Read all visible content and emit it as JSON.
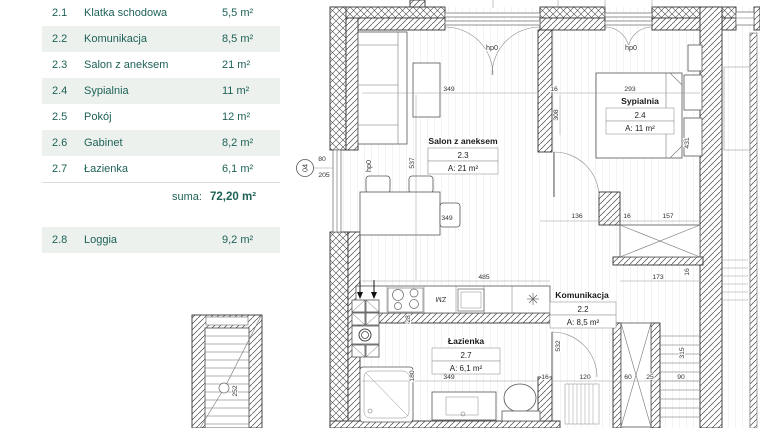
{
  "accent_color": "#1e6257",
  "row_alt_color": "#edf1ed",
  "table": {
    "rows": [
      {
        "no": "2.1",
        "name": "Klatka schodowa",
        "area": "5,5 m²"
      },
      {
        "no": "2.2",
        "name": "Komunikacja",
        "area": "8,5 m²"
      },
      {
        "no": "2.3",
        "name": "Salon z aneksem",
        "area": "21 m²"
      },
      {
        "no": "2.4",
        "name": "Sypialnia",
        "area": "11 m²"
      },
      {
        "no": "2.5",
        "name": "Pokój",
        "area": "12 m²"
      },
      {
        "no": "2.6",
        "name": "Gabinet",
        "area": "8,2 m²"
      },
      {
        "no": "2.7",
        "name": "Łazienka",
        "area": "6,1 m²"
      }
    ],
    "suma_label": "suma:",
    "suma_value": "72,20 m²",
    "extra_row": {
      "no": "2.8",
      "name": "Loggia",
      "area": "9,2 m²"
    }
  },
  "plan": {
    "marker": "04",
    "rooms": {
      "salon": {
        "name": "Salon z aneksem",
        "no": "2.3",
        "area": "A: 21 m²"
      },
      "sypialnia": {
        "name": "Sypialnia",
        "no": "2.4",
        "area": "A: 11 m²"
      },
      "komunikacja": {
        "name": "Komunikacja",
        "no": "2.2",
        "area": "A: 8,5 m²"
      },
      "lazienka": {
        "name": "Łazienka",
        "no": "2.7",
        "area": "A: 6,1 m²"
      }
    },
    "labels": {
      "window": "hp0",
      "sink": "ZM"
    },
    "dims": {
      "d80": "80",
      "d205": "205",
      "d537": "537",
      "salon_349": "349",
      "bed_16": "16",
      "bed_293": "293",
      "bed_308": "308",
      "bed_431": "431",
      "mid_136": "136",
      "mid_16": "16",
      "mid_157": "157",
      "table_349": "349",
      "kitchen_485": "485",
      "w_173": "173",
      "w_16": "16",
      "bath_532": "532",
      "stairs_315": "315",
      "k_28": "28",
      "bath_180": "180",
      "bath_349": "349",
      "bot_16": "16",
      "bot_120": "120",
      "bot_60": "60",
      "bot_25": "25",
      "bot_90": "90",
      "stair_252": "252"
    }
  }
}
